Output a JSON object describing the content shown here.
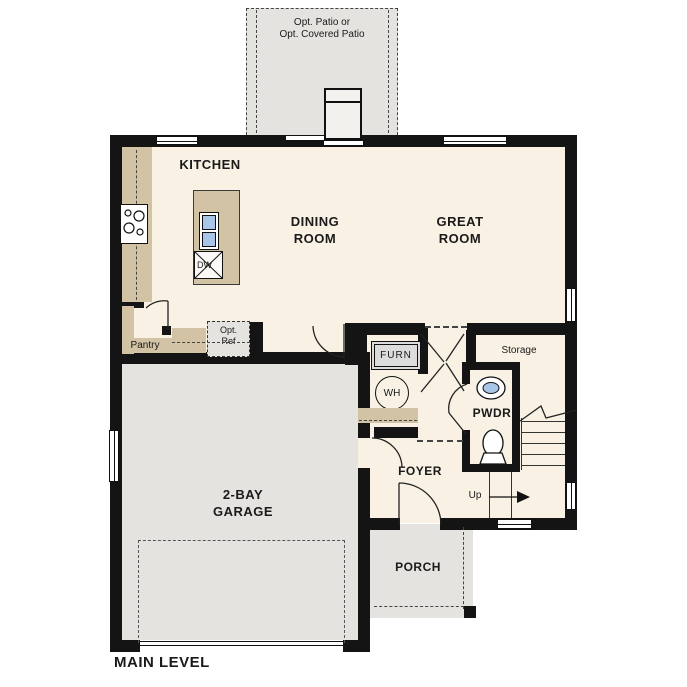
{
  "title": "MAIN LEVEL",
  "labels": {
    "patio_line1": "Opt. Patio or",
    "patio_line2": "Opt. Covered Patio",
    "kitchen": "KITCHEN",
    "dining_line1": "DINING",
    "dining_line2": "ROOM",
    "great_line1": "GREAT",
    "great_line2": "ROOM",
    "pantry": "Pantry",
    "opt_ref_line1": "Opt.",
    "opt_ref_line2": "Ref",
    "furnace": "FURN",
    "water_heater": "WH",
    "dishwasher": "DW",
    "storage": "Storage",
    "powder": "PWDR",
    "foyer": "FOYER",
    "up": "Up",
    "garage_line1": "2-BAY",
    "garage_line2": "GARAGE",
    "porch": "PORCH"
  },
  "colors": {
    "wall": "#141414",
    "floor": "#f8f1e4",
    "counter": "#d2c3a4",
    "exterior": "#e4e3df",
    "blue": "#a9c6e8"
  }
}
